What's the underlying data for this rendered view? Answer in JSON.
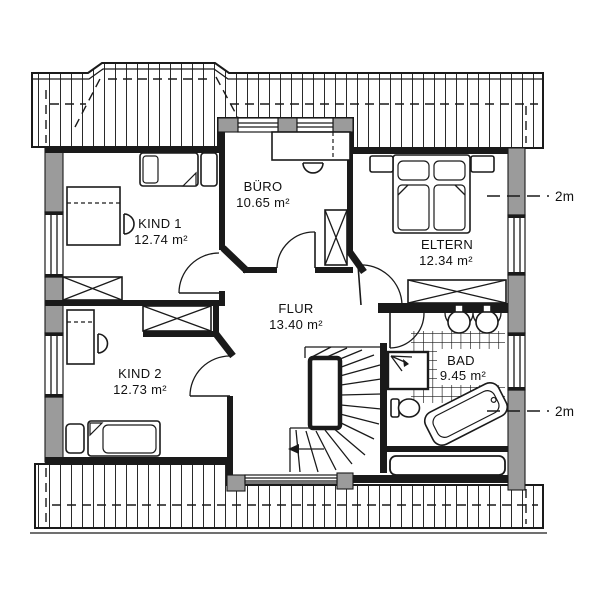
{
  "plan": {
    "title": "Dachgeschoss Grundriss",
    "rooms": [
      {
        "id": "kind1",
        "name": "KIND 1",
        "area": "12.74 m²"
      },
      {
        "id": "kind2",
        "name": "KIND 2",
        "area": "12.73 m²"
      },
      {
        "id": "buero",
        "name": "BÜRO",
        "area": "10.65 m²"
      },
      {
        "id": "eltern",
        "name": "ELTERN",
        "area": "12.34 m²"
      },
      {
        "id": "flur",
        "name": "FLUR",
        "area": "13.40 m²"
      },
      {
        "id": "bad",
        "name": "BAD",
        "area": "9.45 m²"
      }
    ],
    "dimensions": [
      {
        "label": "2m"
      },
      {
        "label": "2m"
      }
    ],
    "colors": {
      "wall_gray": "#9b9b9b",
      "line": "#1a1a1a",
      "bg": "#ffffff"
    }
  }
}
